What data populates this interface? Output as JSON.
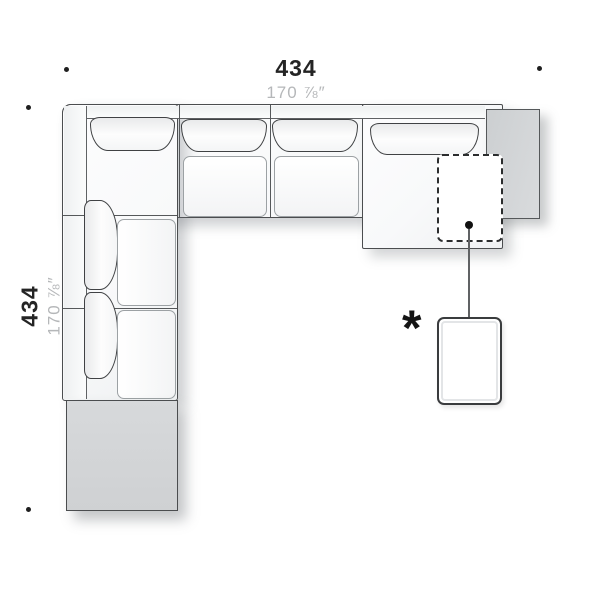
{
  "dimensions": {
    "top": {
      "cm": "434",
      "inches": "170 ⅞″"
    },
    "left": {
      "cm": "434",
      "inches": "170 ⅞″"
    }
  },
  "callout": {
    "marker": "*"
  },
  "colors": {
    "background": "#ffffff",
    "outline": "#4b4d4f",
    "panel_gray": "#d3d5d7",
    "dimension_cm_text": "#242424",
    "dimension_inches_text": "#b5b7b9",
    "dash_outline": "#2b2d2e"
  }
}
